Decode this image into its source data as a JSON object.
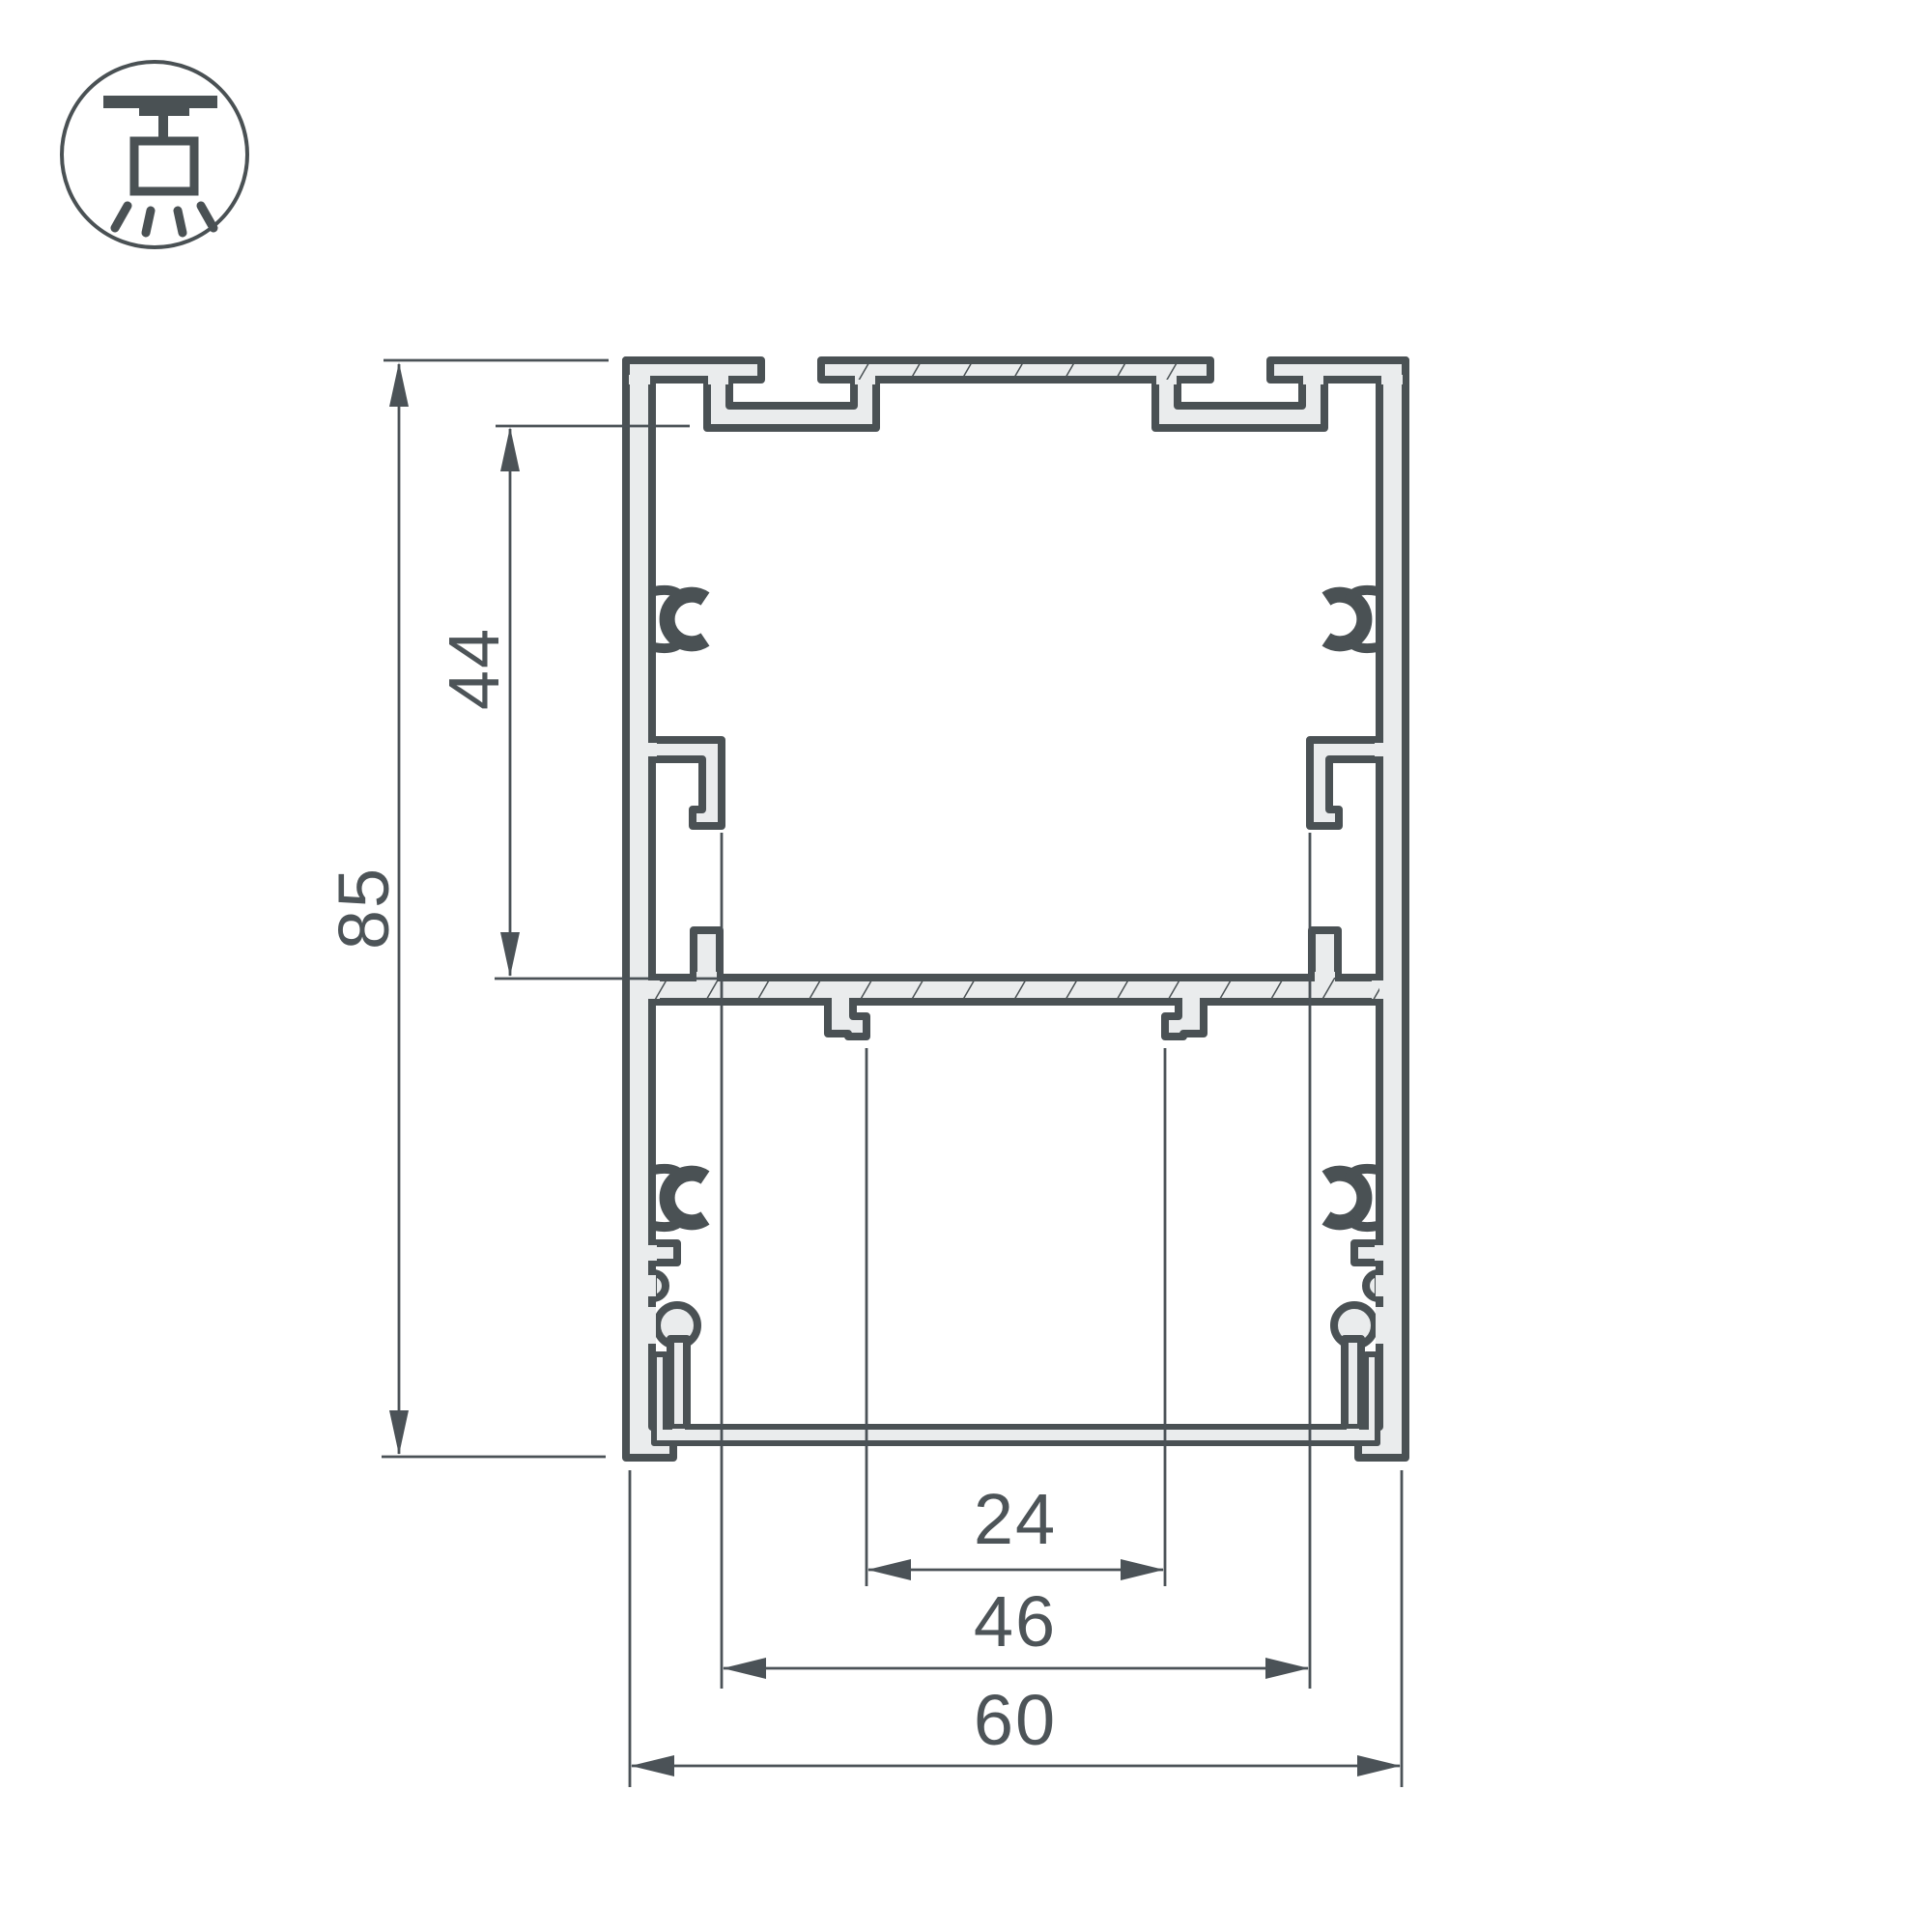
{
  "drawing": {
    "type": "aluminum-profile-cross-section",
    "dimensions": {
      "overall_height": "85",
      "upper_chamber_height": "44",
      "led_slot_width": "24",
      "inner_width": "46",
      "overall_width": "60"
    },
    "icon": {
      "name": "pendant-ceiling-mount-icon"
    },
    "colors": {
      "outline": "#4a5154",
      "metal_fill": "#eaeced",
      "dimension_lines": "#4b5257",
      "dimension_text": "#4d5458",
      "background": "#ffffff"
    }
  }
}
